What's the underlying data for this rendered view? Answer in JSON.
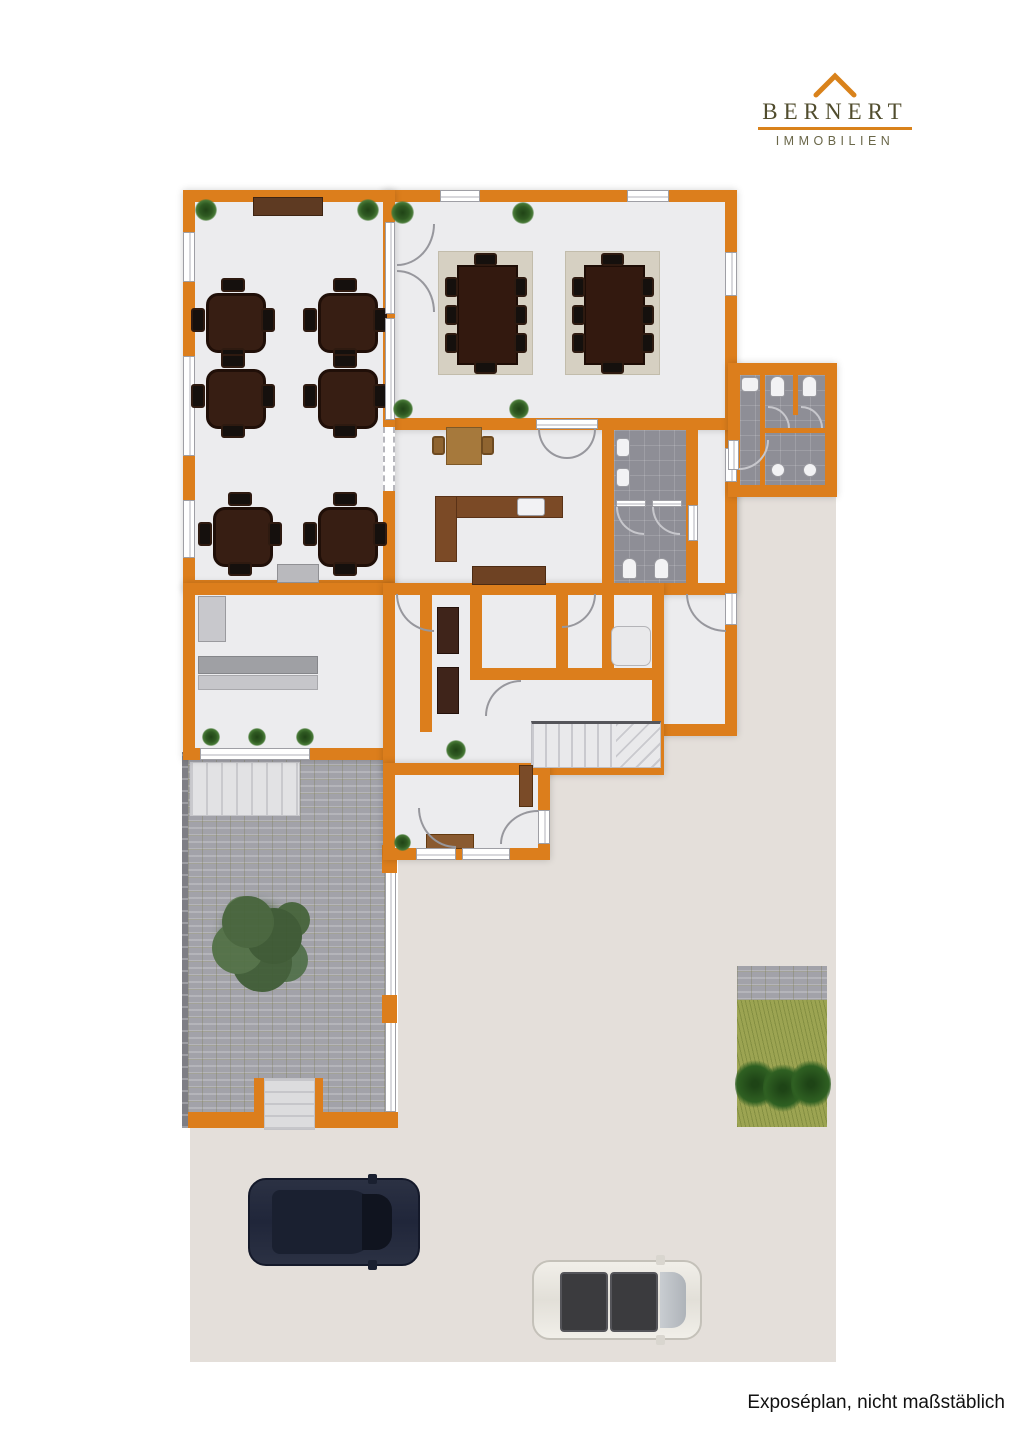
{
  "logo": {
    "brand": "BERNERT",
    "subtitle": "IMMOBILIEN",
    "roof_icon": "roof-outline-icon",
    "brand_color": "#514D2E",
    "accent_color": "#D9821B"
  },
  "caption": {
    "text": "Exposéplan, nicht maßstäblich",
    "color": "#111111"
  },
  "floorplan": {
    "type": "real-estate exposé floor plan, ground floor with outdoor area",
    "colors": {
      "wall": "#DC7E1C",
      "interior_floor": "#ECECEE",
      "outdoor_ground": "#E4DFDA",
      "courtyard_paving": "#A2A2A9",
      "bathroom_tile": "#8E8E96",
      "grass": "#9CA452",
      "dark_wood": "#371E13",
      "rug": "#D6D0C2",
      "kitchen_counter": "#7B4A26",
      "stairs": "#E9E9EB"
    },
    "rooms": [
      "dining-room-with-six-four-seat-tables",
      "function-room-with-two-eight-seat-tables",
      "kitchen",
      "wc-main",
      "wc-annex",
      "service-room-with-counter",
      "pantry-and-hall",
      "entrance-hall-with-stairs"
    ],
    "inventory": {
      "four_seat_tables": 6,
      "eight_seat_tables": 2,
      "rugs": 2,
      "plants": 13,
      "toilets": 4,
      "wash_basins": 6,
      "kitchen_sink": 1,
      "staircases": 1,
      "trees": 1,
      "bushes": 3,
      "cars": 2
    },
    "vehicles": [
      {
        "type": "car-top-view",
        "color": "#262C3E"
      },
      {
        "type": "car-top-view",
        "color": "#EDEAE4"
      }
    ]
  }
}
